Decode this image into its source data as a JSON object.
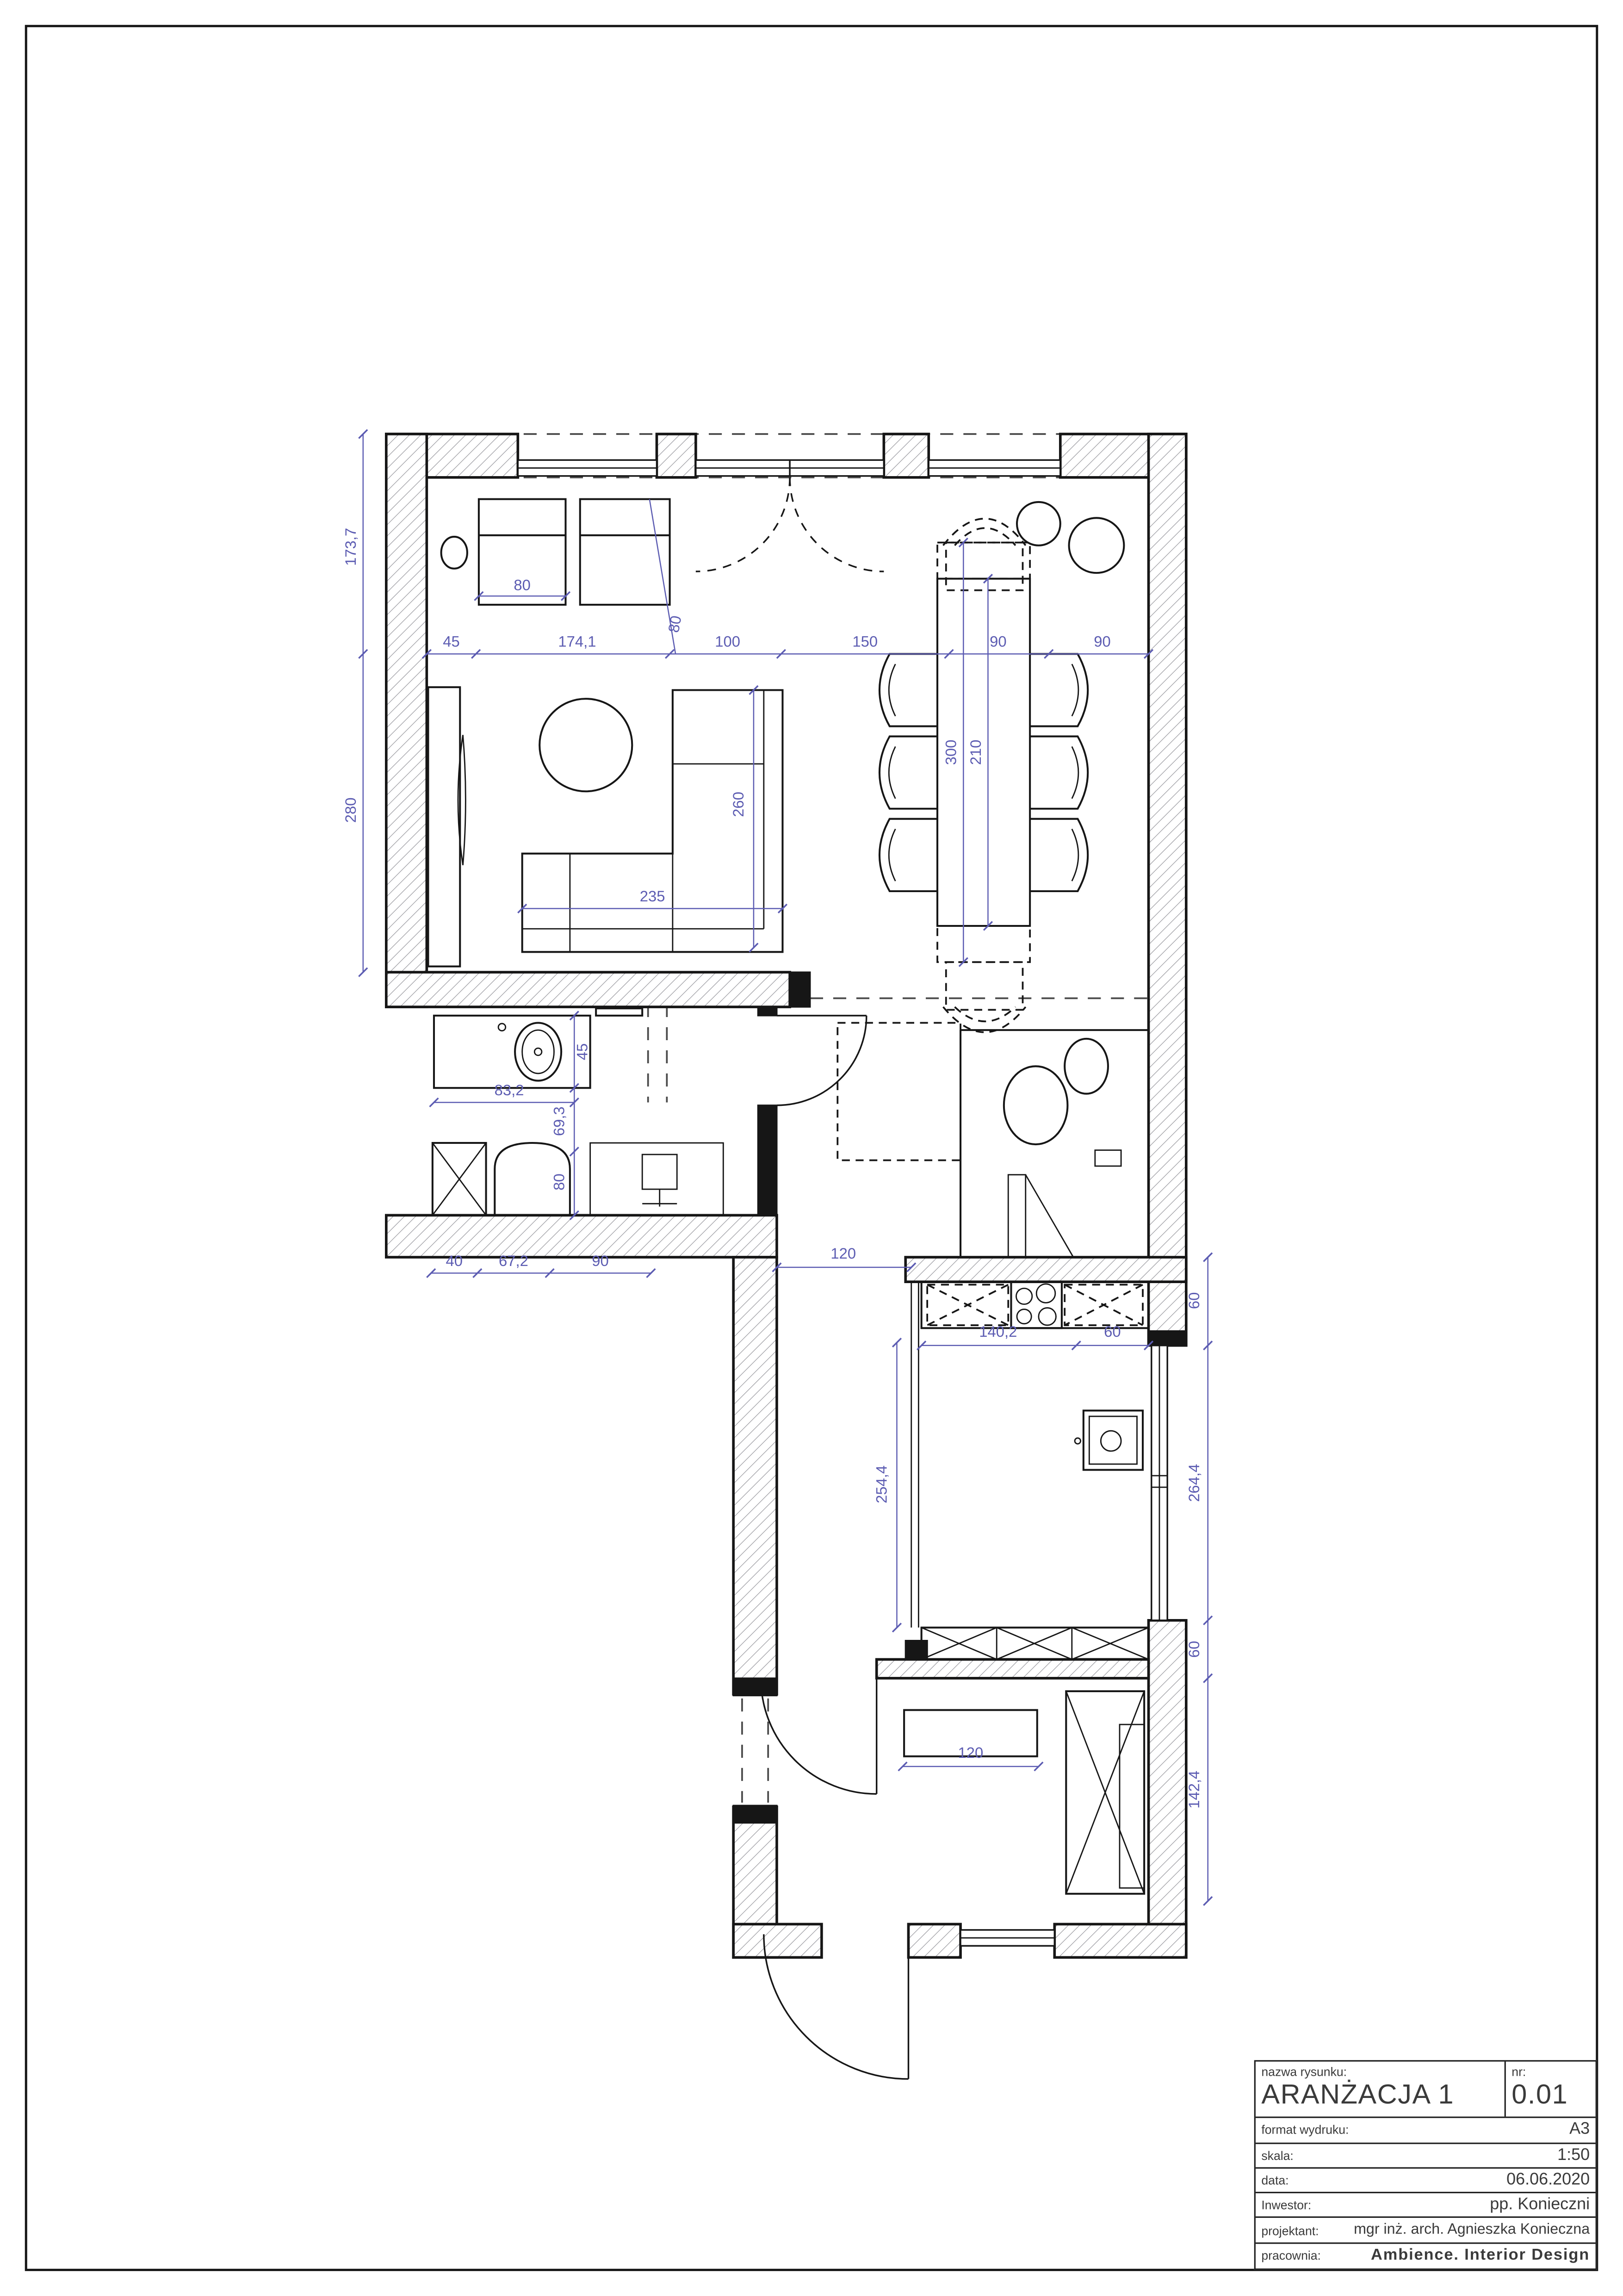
{
  "page": {
    "bg": "#ffffff",
    "line_color": "#161616",
    "hatch_color": "#9a9aa0",
    "dim_color": "#5c5cb2"
  },
  "title_block": {
    "nazwa_label": "nazwa rysunku:",
    "nazwa_value": "ARANŻACJA 1",
    "nr_label": "nr:",
    "nr_value": "0.01",
    "format_label": "format wydruku:",
    "format_value": "A3",
    "skala_label": "skala:",
    "skala_value": "1:50",
    "data_label": "data:",
    "data_value": "06.06.2020",
    "inwestor_label": "Inwestor:",
    "inwestor_value": "pp. Konieczni",
    "projektant_label": "projektant:",
    "projektant_value": "mgr inż. arch. Agnieszka Konieczna",
    "pracownia_label": "pracownia:",
    "pracownia_value": "Ambience. Interior Design"
  },
  "dims": {
    "d80_armchair": "80",
    "d45": "45",
    "d174": "174,1",
    "d100": "100",
    "d150": "150",
    "d90a": "90",
    "d90b": "90",
    "d80_diag": "80",
    "d173": "173,7",
    "d280": "280",
    "d260": "260",
    "d235": "235",
    "d300": "300",
    "d210": "210",
    "d83": "83,2",
    "d45_b": "45",
    "d69": "69,3",
    "d80_shower": "80",
    "d40": "40",
    "d67": "67,2",
    "d90_c": "90",
    "d120_hall": "120",
    "d140": "140,2",
    "d60_a": "60",
    "d254": "254,4",
    "d60_b": "60",
    "d264": "264,4",
    "d60_c": "60",
    "d142": "142,4",
    "d120_bench": "120"
  }
}
